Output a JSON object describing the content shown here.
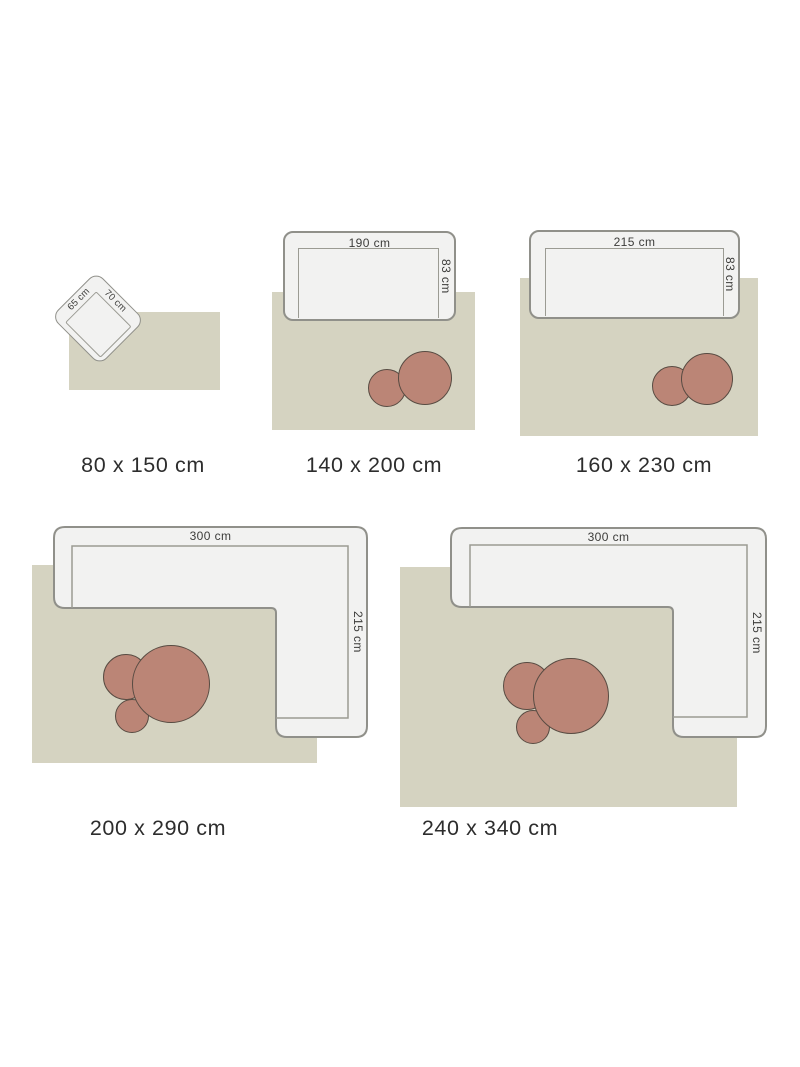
{
  "colors": {
    "rug": "#d5d3c1",
    "sofa_fill": "#f2f2f1",
    "sofa_stroke": "#90908a",
    "seat_stroke": "#9b9b93",
    "table_fill": "#bb8576",
    "table_stroke": "#584b42",
    "dim_text": "#3c3c3a",
    "label_text": "#2d2d2d"
  },
  "panels": [
    {
      "size_label": "80 x 150 cm",
      "furniture": "armchair",
      "furniture_width": "65 cm",
      "furniture_depth": "70 cm",
      "tables": 0
    },
    {
      "size_label": "140 x 200 cm",
      "furniture": "sofa",
      "furniture_width": "190 cm",
      "furniture_depth": "83 cm",
      "tables": 2
    },
    {
      "size_label": "160 x 230 cm",
      "furniture": "sofa",
      "furniture_width": "215 cm",
      "furniture_depth": "83 cm",
      "tables": 2
    },
    {
      "size_label": "200 x 290 cm",
      "furniture": "corner-sofa",
      "furniture_width": "300 cm",
      "furniture_depth": "215 cm",
      "tables": 3
    },
    {
      "size_label": "240 x 340 cm",
      "furniture": "corner-sofa",
      "furniture_width": "300 cm",
      "furniture_depth": "215 cm",
      "tables": 3
    }
  ]
}
